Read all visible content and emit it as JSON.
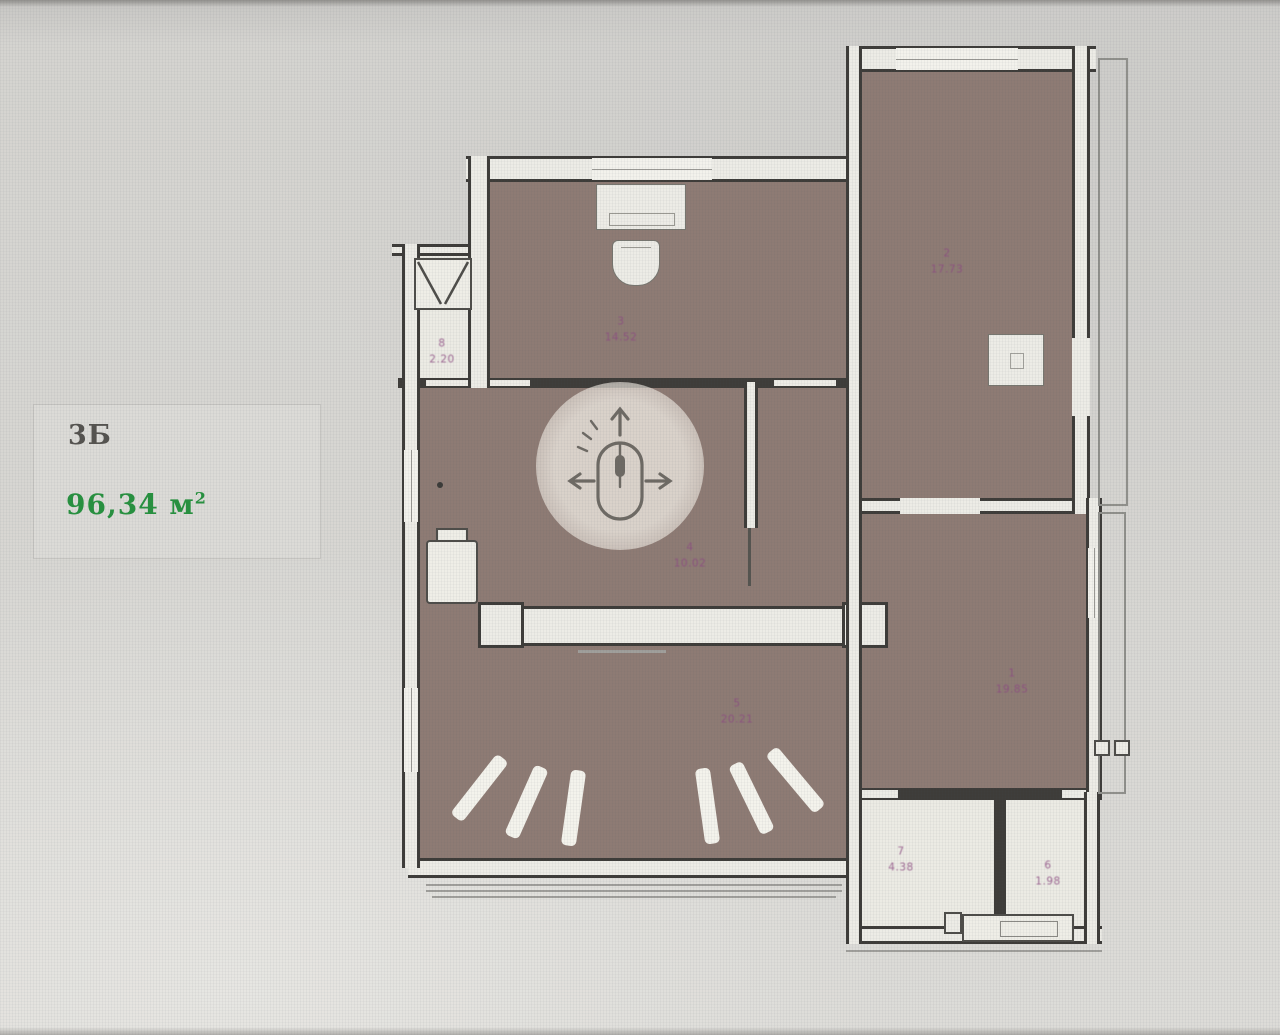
{
  "info_panel": {
    "plan_code": "3Б",
    "area_text": "96,34 м",
    "area_sup": "2"
  },
  "rooms": [
    {
      "number": "1",
      "area": "19.85"
    },
    {
      "number": "2",
      "area": "17.73"
    },
    {
      "number": "3",
      "area": "14.52"
    },
    {
      "number": "4",
      "area": "10.02"
    },
    {
      "number": "5",
      "area": "20.21"
    },
    {
      "number": "6",
      "area": "1.98"
    },
    {
      "number": "7",
      "area": "4.38"
    },
    {
      "number": "8",
      "area": "2.20"
    }
  ],
  "icons": {
    "pan_mouse": "mouse-pan-icon",
    "ventilation": "ventilation-shaft-icon",
    "sink": "sink-icon",
    "washing_machine": "washing-machine-icon",
    "electric_panel": "electric-panel-icon"
  },
  "colors": {
    "wall": "#3e3c39",
    "room_fill": "#8e7b74",
    "wet_room_fill": "#ecebe4",
    "label_purple": "#8d4b82",
    "area_green": "#27913f",
    "plan_code_gray": "#55534f",
    "background": "#d6d5d1"
  }
}
